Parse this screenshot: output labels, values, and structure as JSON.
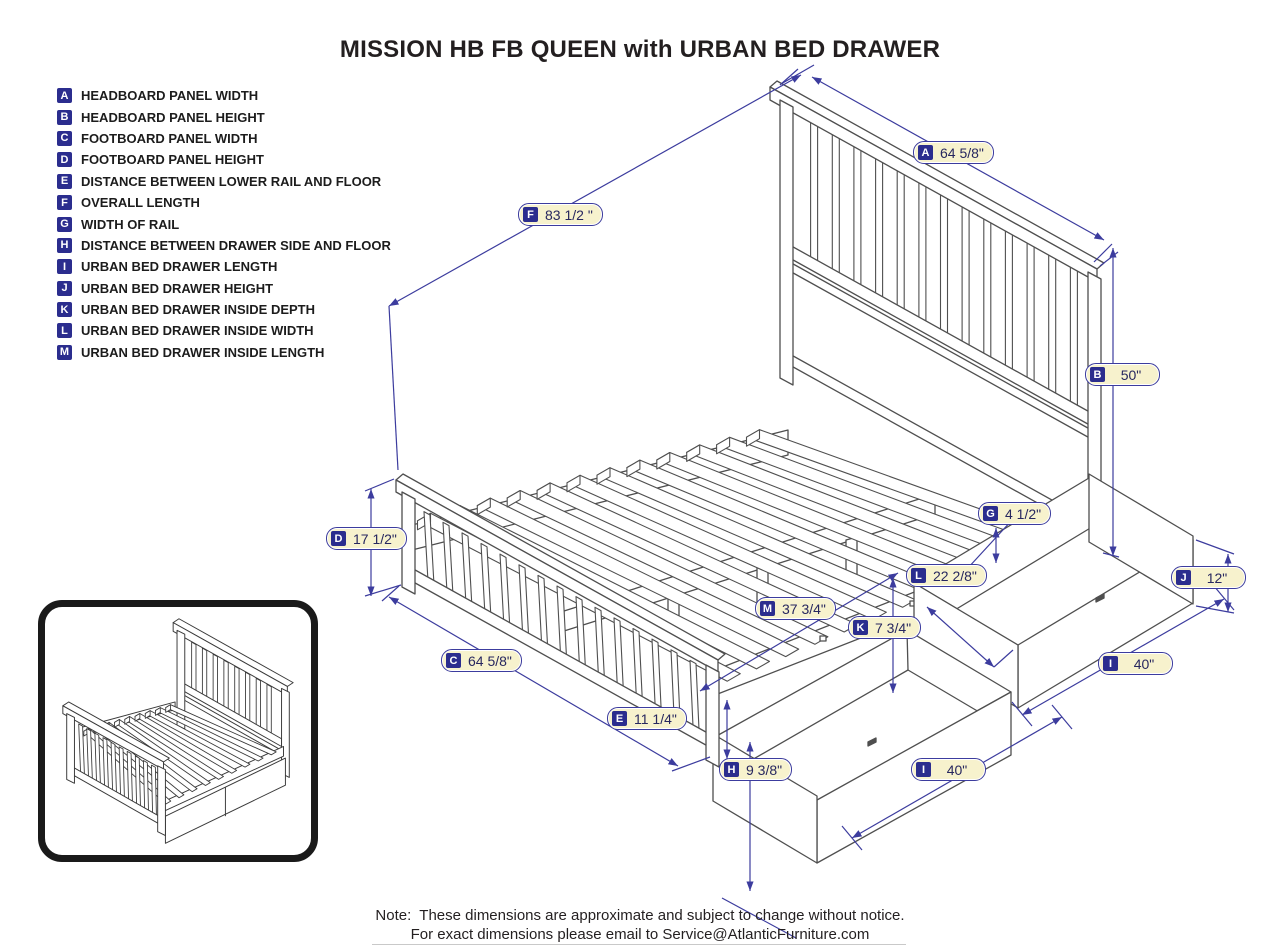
{
  "title": "MISSION HB FB QUEEN with URBAN BED DRAWER",
  "legend": {
    "items": [
      {
        "letter": "A",
        "label": "HEADBOARD PANEL WIDTH"
      },
      {
        "letter": "B",
        "label": "HEADBOARD PANEL HEIGHT"
      },
      {
        "letter": "C",
        "label": "FOOTBOARD PANEL WIDTH"
      },
      {
        "letter": "D",
        "label": "FOOTBOARD PANEL HEIGHT"
      },
      {
        "letter": "E",
        "label": "DISTANCE BETWEEN LOWER RAIL AND FLOOR"
      },
      {
        "letter": "F",
        "label": "OVERALL LENGTH"
      },
      {
        "letter": "G",
        "label": "WIDTH OF RAIL"
      },
      {
        "letter": "H",
        "label": "DISTANCE BETWEEN DRAWER SIDE AND FLOOR"
      },
      {
        "letter": "I",
        "label": "URBAN BED DRAWER LENGTH"
      },
      {
        "letter": "J",
        "label": "URBAN BED DRAWER HEIGHT"
      },
      {
        "letter": "K",
        "label": "URBAN BED DRAWER INSIDE DEPTH"
      },
      {
        "letter": "L",
        "label": "URBAN BED DRAWER INSIDE WIDTH"
      },
      {
        "letter": "M",
        "label": "URBAN BED DRAWER INSIDE LENGTH"
      }
    ]
  },
  "dims": [
    {
      "letter": "A",
      "value": "64 5/8\""
    },
    {
      "letter": "F",
      "value": "83 1/2 \""
    },
    {
      "letter": "B",
      "value": "50\""
    },
    {
      "letter": "G",
      "value": "4 1/2\""
    },
    {
      "letter": "L",
      "value": "22 2/8\""
    },
    {
      "letter": "J",
      "value": "12\""
    },
    {
      "letter": "M",
      "value": "37 3/4\""
    },
    {
      "letter": "K",
      "value": "7 3/4\""
    },
    {
      "letter": "D",
      "value": "17 1/2\""
    },
    {
      "letter": "C",
      "value": "64 5/8\""
    },
    {
      "letter": "E",
      "value": "11 1/4\""
    },
    {
      "letter": "I",
      "value": "40\""
    },
    {
      "letter": "H",
      "value": "9 3/8\""
    },
    {
      "letter": "I",
      "value": "40\""
    }
  ],
  "note": {
    "prefix": "Note:",
    "line1": "These dimensions are approximate and subject to change without notice.",
    "line2": "For exact dimensions please email to Service@AtlanticFurniture.com"
  },
  "colors": {
    "dimension_accent": "#3c3c9e",
    "badge_navy": "#2b2d8e",
    "label_cream": "#f7f2cd",
    "line_art": "#4f4f4f"
  }
}
